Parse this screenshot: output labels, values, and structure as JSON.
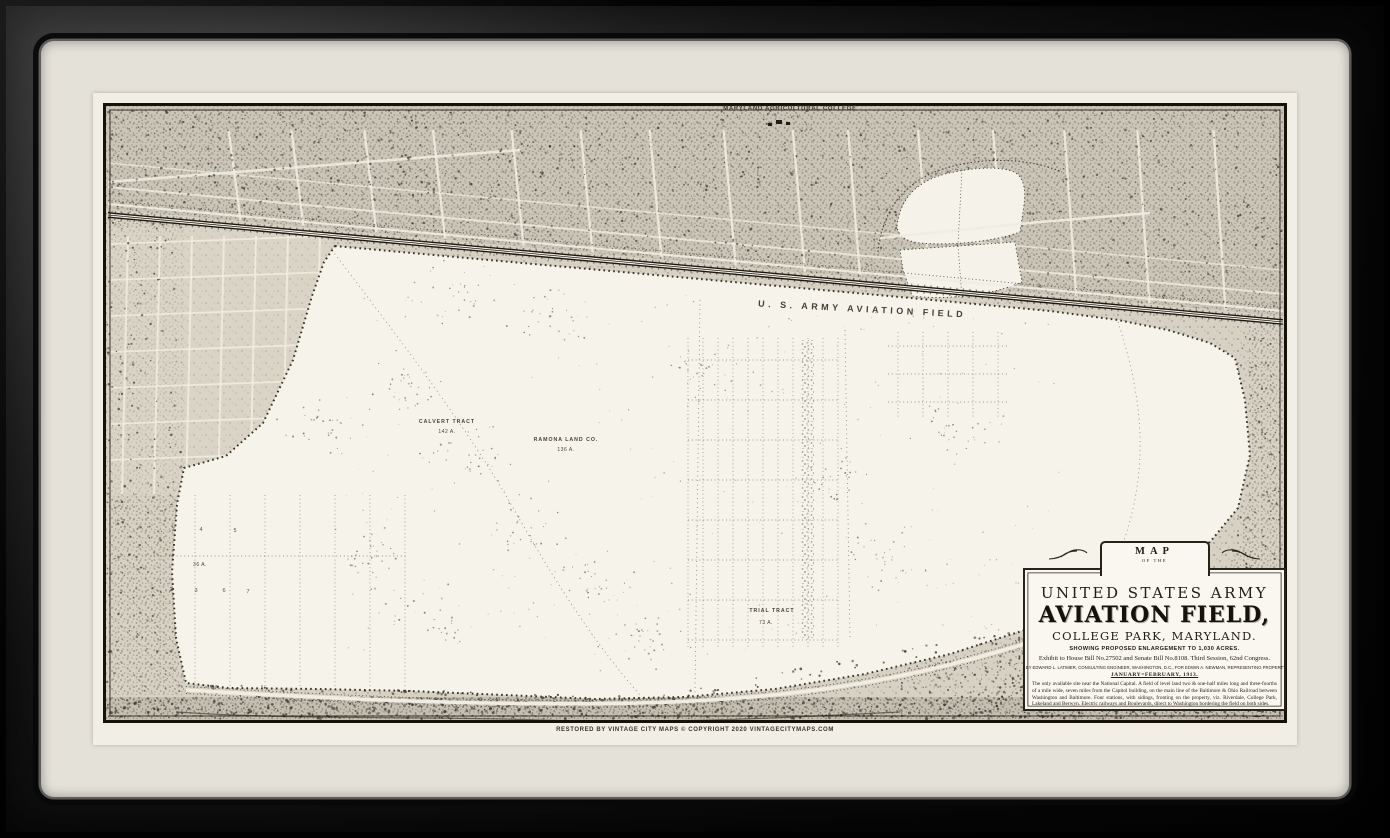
{
  "frame": {
    "frame_color": "#0d0d0d",
    "mat_color": "#e4e1d8",
    "paper_color": "#f1efe5",
    "ink_color": "#27221a"
  },
  "map": {
    "top_label": "MARYLAND AGRICULTURAL COLLEGE",
    "field_label": "U. S. ARMY AVIATION FIELD",
    "labels": {
      "tract1_name": "CALVERT TRACT",
      "tract1_area": "142 A.",
      "tract2_name": "RAMONA LAND CO.",
      "tract2_area": "136 A.",
      "tract3_name": "TRIAL TRACT",
      "tract3_area": "73 A.",
      "parcel_area": "36 A.",
      "parcel_numbers": [
        "1",
        "4",
        "5",
        "2",
        "3",
        "6",
        "7"
      ]
    },
    "cartouche": {
      "map_word": "MAP",
      "of_the": "OF THE",
      "army_line": "UNITED STATES ARMY",
      "title": "AVIATION FIELD,",
      "place": "COLLEGE PARK, MARYLAND.",
      "showing": "SHOWING PROPOSED ENLARGEMENT TO 1,030 ACRES.",
      "exhibit": "Exhibit to House Bill No.27502 and Senate Bill No.8108. Third Session, 62nd Congress.",
      "prepared": "PREPARED BY EDWARD L. LATIMER, CONSULTING ENGINEER, WASHINGTON, D.C., FOR EDWIN A. NEWMAN, REPRESENTING PROPERTY OWNERS.",
      "date_line": "JANUARY=FEBRUARY, 1913.",
      "paragraph": "The only available site near the National Capital. A field of level land two & one-half miles long and three-fourths of a mile wide, seven miles from the Capitol building, on the main line of the Baltimore & Ohio Railroad between Washington and Baltimore. Four stations, with sidings, fronting on the property, viz. Riverdale, College Park, Lakeland and Berwyn. Electric railways and Boulevards, direct to Washington bordering the field on both sides.",
      "scale_note": "SCALE: 1 INCH = 320 FEET"
    },
    "caption": "RESTORED BY VINTAGE CITY MAPS © COPYRIGHT 2020 VINTAGECITYMAPS.COM"
  }
}
